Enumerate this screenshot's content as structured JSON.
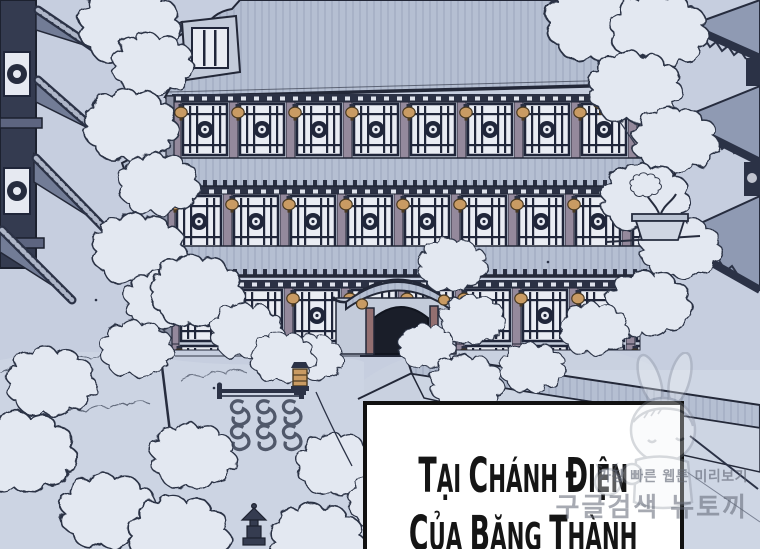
{
  "caption": {
    "lines": [
      "TẠI CHÁNH ĐIỆN",
      "CỦA BĂNG THÀNH"
    ]
  },
  "watermark": {
    "line1": "가장 빠른 웹툰 미리보기",
    "line2": "구글검색 뉴토끼",
    "mascot_icon": "bunny-girl-mascot"
  },
  "colors": {
    "background": "#c6cedf",
    "ground": "#ccd4e3",
    "line": "#232838",
    "ink_dark": "#1a1e29",
    "roof": "#b5bfd2",
    "roof_streak": "#9aa5bc",
    "wall": "#c3cbda",
    "window_paper": "#e9ecf3",
    "lattice": "#20263a",
    "column": "#94899c",
    "lantern": "#c99b63",
    "lantern_rim": "#4a3a22",
    "snow": "#e3e8f1",
    "pagoda_dark": "#343b50",
    "caption_bg": "#ffffff",
    "caption_border": "#111111",
    "caption_text": "#151515",
    "watermark": "#606674"
  }
}
